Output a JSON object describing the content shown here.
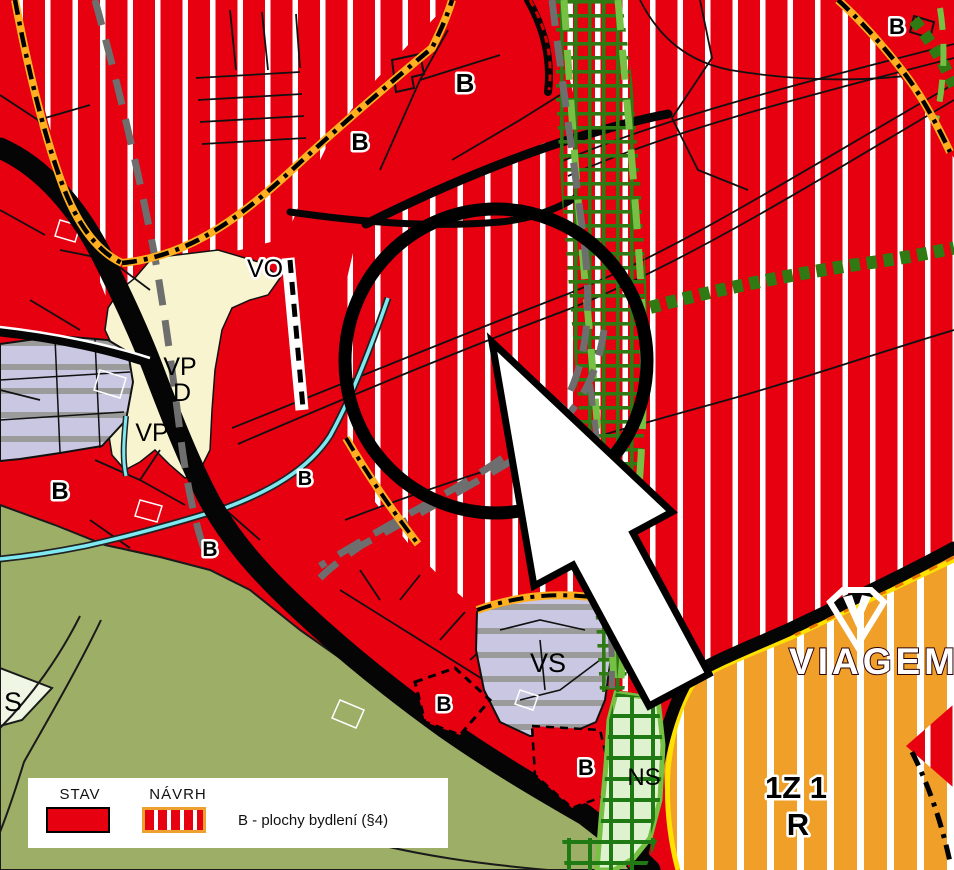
{
  "map": {
    "title": "zoning-plan-map",
    "region_labels": [
      {
        "text": "B",
        "x": 465,
        "y": 92,
        "size": 26,
        "bold": true,
        "halo": true
      },
      {
        "text": "B",
        "x": 360,
        "y": 150,
        "size": 24,
        "bold": true,
        "halo": true
      },
      {
        "text": "B",
        "x": 897,
        "y": 34,
        "size": 22,
        "bold": true,
        "halo": true
      },
      {
        "text": "VO",
        "x": 265,
        "y": 277,
        "size": 25,
        "bold": false,
        "halo": true
      },
      {
        "text": "VP",
        "x": 180,
        "y": 375,
        "size": 25,
        "bold": false,
        "halo": false
      },
      {
        "text": "D",
        "x": 182,
        "y": 401,
        "size": 25,
        "bold": false,
        "halo": false
      },
      {
        "text": "VP",
        "x": 152,
        "y": 441,
        "size": 25,
        "bold": false,
        "halo": false
      },
      {
        "text": "B",
        "x": 60,
        "y": 499,
        "size": 24,
        "bold": true,
        "halo": true
      },
      {
        "text": "B",
        "x": 210,
        "y": 556,
        "size": 21,
        "bold": true,
        "halo": true
      },
      {
        "text": "B",
        "x": 305,
        "y": 485,
        "size": 20,
        "bold": true,
        "halo": true
      },
      {
        "text": "VS",
        "x": 548,
        "y": 672,
        "size": 27,
        "bold": false,
        "halo": false
      },
      {
        "text": "B",
        "x": 444,
        "y": 711,
        "size": 21,
        "bold": true,
        "halo": true
      },
      {
        "text": "B",
        "x": 586,
        "y": 775,
        "size": 22,
        "bold": true,
        "halo": true
      },
      {
        "text": "NS",
        "x": 644,
        "y": 785,
        "size": 24,
        "bold": false,
        "halo": false
      },
      {
        "text": "S",
        "x": 13,
        "y": 711,
        "size": 27,
        "bold": false,
        "halo": false
      },
      {
        "text": "1Z 1",
        "x": 796,
        "y": 798,
        "size": 31,
        "bold": true,
        "halo": true
      },
      {
        "text": "R",
        "x": 798,
        "y": 835,
        "size": 31,
        "bold": true,
        "halo": true
      }
    ]
  },
  "legend": {
    "stav_label": "STAV",
    "navrh_label": "NÁVRH",
    "item_label": "B - plochy bydlení (§4)"
  },
  "logo": {
    "text": "VIAGEM"
  },
  "annotations": {
    "circle_color": "#000000",
    "arrow_fill": "#FFFFFF"
  },
  "colors": {
    "housing_red": "#E60010",
    "stripe_white": "#FFFFFF",
    "orange_zone": "#F0A028",
    "olive_green": "#9DAE67",
    "cream_zone": "#F8F4D0",
    "lavender_zone": "#C9C7E2",
    "ns_pale_green": "#DFF2CF",
    "grid_dark_green": "#2F7A12",
    "light_green": "#76C043",
    "road_black": "#050505",
    "gray_dash": "#6E6E6E",
    "stream_cyan": "#7FE9F2",
    "boundary_glow_orange": "#FFB020",
    "yellow_border": "#FFE100",
    "legend_swatch_border": "#F0A030"
  }
}
